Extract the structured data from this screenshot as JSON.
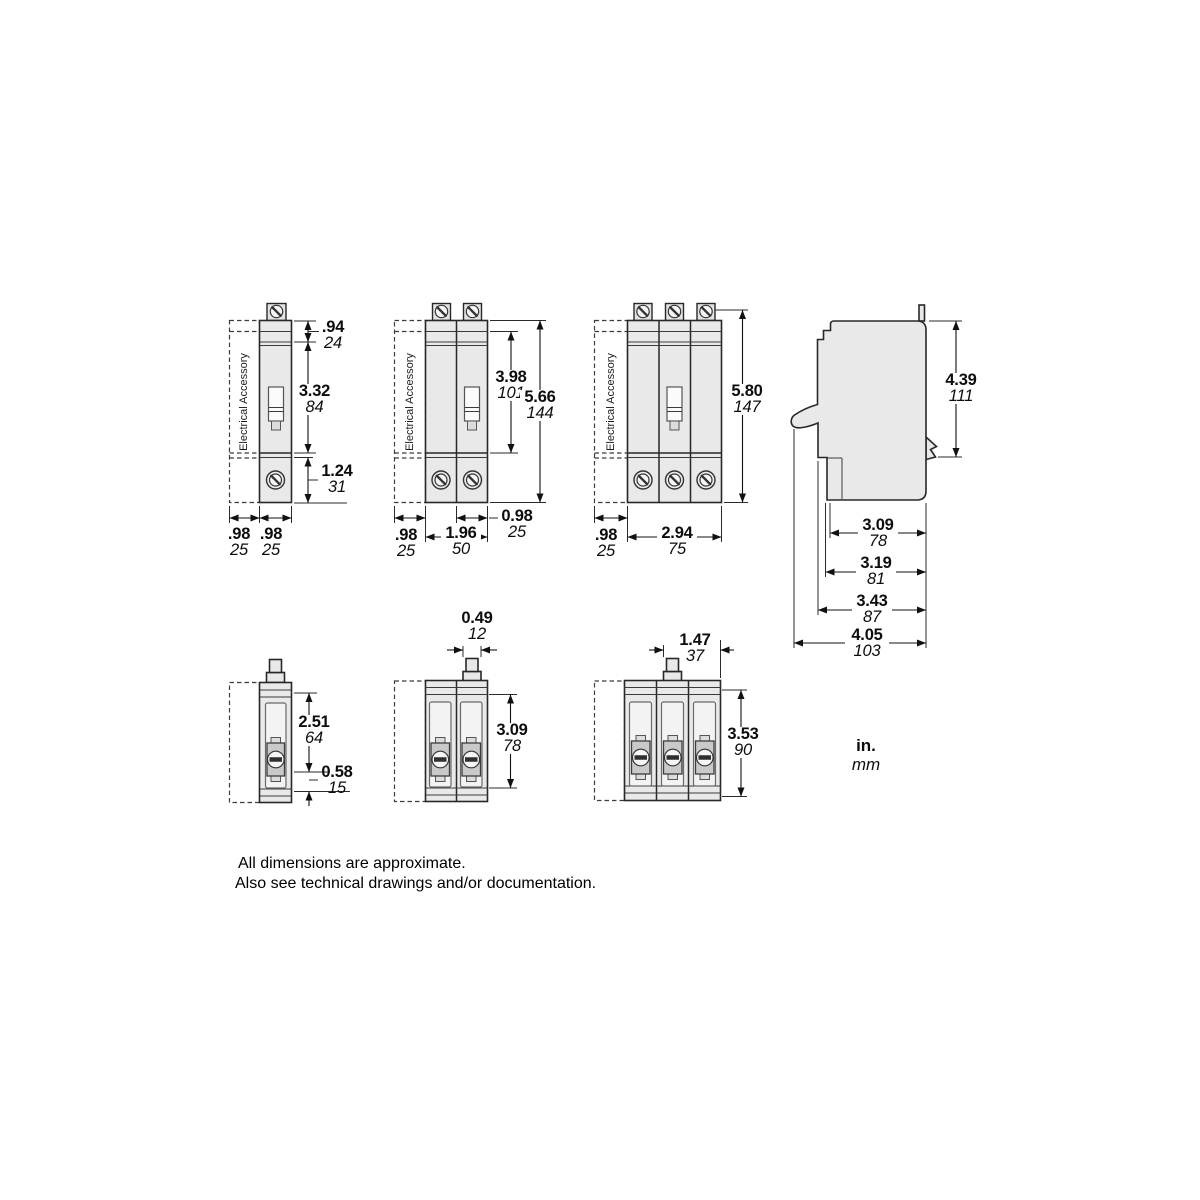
{
  "drawing": {
    "accessory_label": "Electrical Accessory",
    "units": {
      "inches": "in.",
      "millimeters": "mm"
    },
    "notes": [
      "All dimensions are approximate.",
      "Also see technical drawings and/or documentation."
    ],
    "views": {
      "front_1pole": {
        "height_top": {
          "in_val": ".94",
          "mm_val": "24"
        },
        "height_mid": {
          "in_val": "3.32",
          "mm_val": "84"
        },
        "height_bottom": {
          "in_val": "1.24",
          "mm_val": "31"
        },
        "width_accessory": {
          "in_val": ".98",
          "mm_val": "25"
        },
        "width_pole": {
          "in_val": ".98",
          "mm_val": "25"
        }
      },
      "front_2pole": {
        "height_inner": {
          "in_val": "3.98",
          "mm_val": "101"
        },
        "height_total": {
          "in_val": "5.66",
          "mm_val": "144"
        },
        "width_pole": {
          "in_val": "0.98",
          "mm_val": "25"
        },
        "width_accessory": {
          "in_val": ".98",
          "mm_val": "25"
        },
        "width_total": {
          "in_val": "1.96",
          "mm_val": "50"
        }
      },
      "front_3pole": {
        "height_total": {
          "in_val": "5.80",
          "mm_val": "147"
        },
        "width_accessory": {
          "in_val": ".98",
          "mm_val": "25"
        },
        "width_total": {
          "in_val": "2.94",
          "mm_val": "75"
        }
      },
      "side": {
        "height": {
          "in_val": "4.39",
          "mm_val": "111"
        },
        "depth_a": {
          "in_val": "3.09",
          "mm_val": "78"
        },
        "depth_b": {
          "in_val": "3.19",
          "mm_val": "81"
        },
        "depth_c": {
          "in_val": "3.43",
          "mm_val": "87"
        },
        "depth_d": {
          "in_val": "4.05",
          "mm_val": "103"
        }
      },
      "top_1pole": {
        "depth_body": {
          "in_val": "2.51",
          "mm_val": "64"
        },
        "depth_lug": {
          "in_val": "0.58",
          "mm_val": "15"
        }
      },
      "top_2pole": {
        "handle_width": {
          "in_val": "0.49",
          "mm_val": "12"
        },
        "depth": {
          "in_val": "3.09",
          "mm_val": "78"
        }
      },
      "top_3pole": {
        "handle_offset": {
          "in_val": "1.47",
          "mm_val": "37"
        },
        "depth": {
          "in_val": "3.53",
          "mm_val": "90"
        }
      }
    }
  }
}
